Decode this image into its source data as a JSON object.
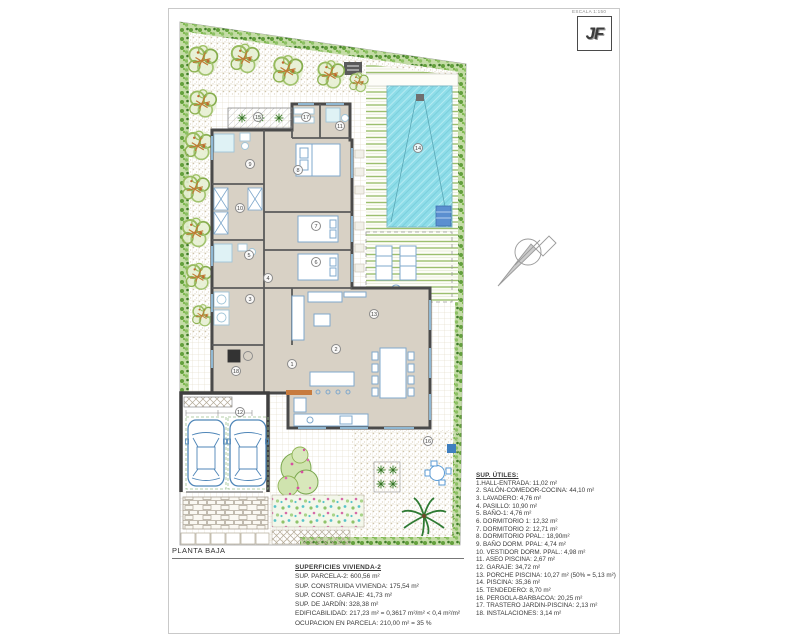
{
  "sheet": {
    "scale_label": "ESCALA 1:150",
    "logo_text": "JF",
    "plan_title": "PLANTA BAJA"
  },
  "rooms": [
    "1",
    "2",
    "3",
    "4",
    "5",
    "6",
    "7",
    "8",
    "9",
    "10",
    "11",
    "12",
    "13",
    "14",
    "15",
    "16",
    "17",
    "18"
  ],
  "legend_utiles": {
    "title": "SUP. ÚTILES:",
    "items": [
      "1.HALL-ENTRADA: 11,02 m²",
      "2. SALÓN-COMEDOR-COCINA: 44,10 m²",
      "3. LAVADERO: 4,76 m²",
      "4. PASILLO: 10,90 m²",
      "5. BAÑO-1: 4,76 m²",
      "6. DORMITORIO 1: 12,32 m²",
      "7. DORMITORIO 2: 12,71 m²",
      "8. DORMITORIO PPAL.: 18,90m²",
      "9. BAÑO DORM. PPAL: 4,74 m²",
      "10. VESTIDOR DORM. PPAL.: 4,98 m²",
      "11. ASEO PISCINA:  2,67 m²",
      "12. GARAJE: 34,72 m²",
      "13. PORCHE PISCINA: 10,27 m² (50% = 5,13 m²)",
      "14. PISCINA: 35,36 m²",
      "15. TENDEDERO: 8,70 m²",
      "16. PERGOLA-BARBACOA: 20,25 m²",
      "17. TRASTERO JARDIN-PISCINA: 2,13 m²",
      "18. INSTALACIONES: 3,14 m²"
    ]
  },
  "superficies": {
    "title": "SUPERFICIES VIVIENDA-2",
    "lines": [
      "SUP. PARCELA-2: 600,56 m²",
      "SUP. CONSTRUIDA VIVIENDA: 175,54 m²",
      "SUP. CONST. GARAJE: 41,73 m²",
      "SUP. DE JARDÍN: 328,38 m²",
      "EDIFICABILIDAD: 217,23  m² = 0,3617 m²/m² < 0,4 m²/m²",
      "OCUPACION EN PARCELA: 210,00 m² = 35 %"
    ]
  },
  "colors": {
    "pool": "#8edde9",
    "hedge_green": "#6aa644",
    "house_fill": "#d8d1c5",
    "wall": "#4a4a4a",
    "furniture": "#7fa8cc",
    "deck_stripe": "#9cbf6e"
  }
}
